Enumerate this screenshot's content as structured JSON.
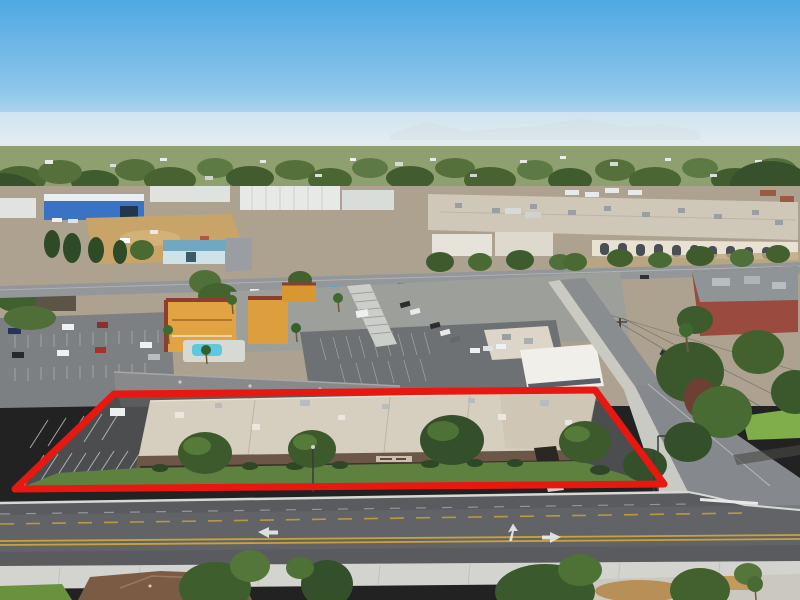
{
  "meta": {
    "title": "Aerial property photograph",
    "media_type": "aerial-drone-photo",
    "description": "Aerial drone view of a single-story commercial plaza outlined in red, with front lawn, shade trees and striped parking inside the outline; a wide street with double-yellow lines and white turn arrows in the foreground; a side street at right; a motel with swimming pool, carports, offices, a blue warehouse, a large beige shopping center and a brick building behind; hazy suburbs, tree line and faint mountains on the horizon."
  },
  "highlight": {
    "shape": "quadrilateral",
    "points": "114,394 595,390 664,484 15,489",
    "color": "#e81810",
    "stroke_width": 7
  },
  "sign": {
    "location": "plaza building fascia",
    "legible": false
  },
  "road_markings": {
    "turn_arrows": 3,
    "center_line": "double-yellow"
  },
  "colors": {
    "sky_top": "#4fa8e2",
    "sky_mid": "#8ec6ea",
    "sky_horizon": "#dce9ef",
    "haze": "#edf2f4",
    "mountains": "#b9c7d3",
    "treeline": "#8ea06f",
    "ground": "#aca28f",
    "dirt_lot": "#c9a469",
    "warehouse_blue": "#3a73c4",
    "shopping_center_roof": "#cfc7b8",
    "shopping_center_wall": "#e9e2d3",
    "brick_building": "#9a4a3e",
    "road_gray": "#94979a",
    "main_street": "#595b5e",
    "parking_asphalt": "#4b4d4f",
    "motel_orange": "#e2a443",
    "motel_trim": "#8d3f2f",
    "pool_blue": "#5ec8e0",
    "plaza_roof_tan": "#d6cebe",
    "plaza_fascia_brown": "#6b5647",
    "lawn_green": "#5f8140",
    "tree_green_dark": "#3c5a2c",
    "tree_green_light": "#567a38",
    "tree_red_leaf": "#6e4034",
    "sidewalk": "#d3d4cf",
    "house_roof_brown": "#7c5b44",
    "line_yellow": "#c9a23a",
    "marking_white": "#e8eaea",
    "car_blue": "#2a4ea0"
  }
}
